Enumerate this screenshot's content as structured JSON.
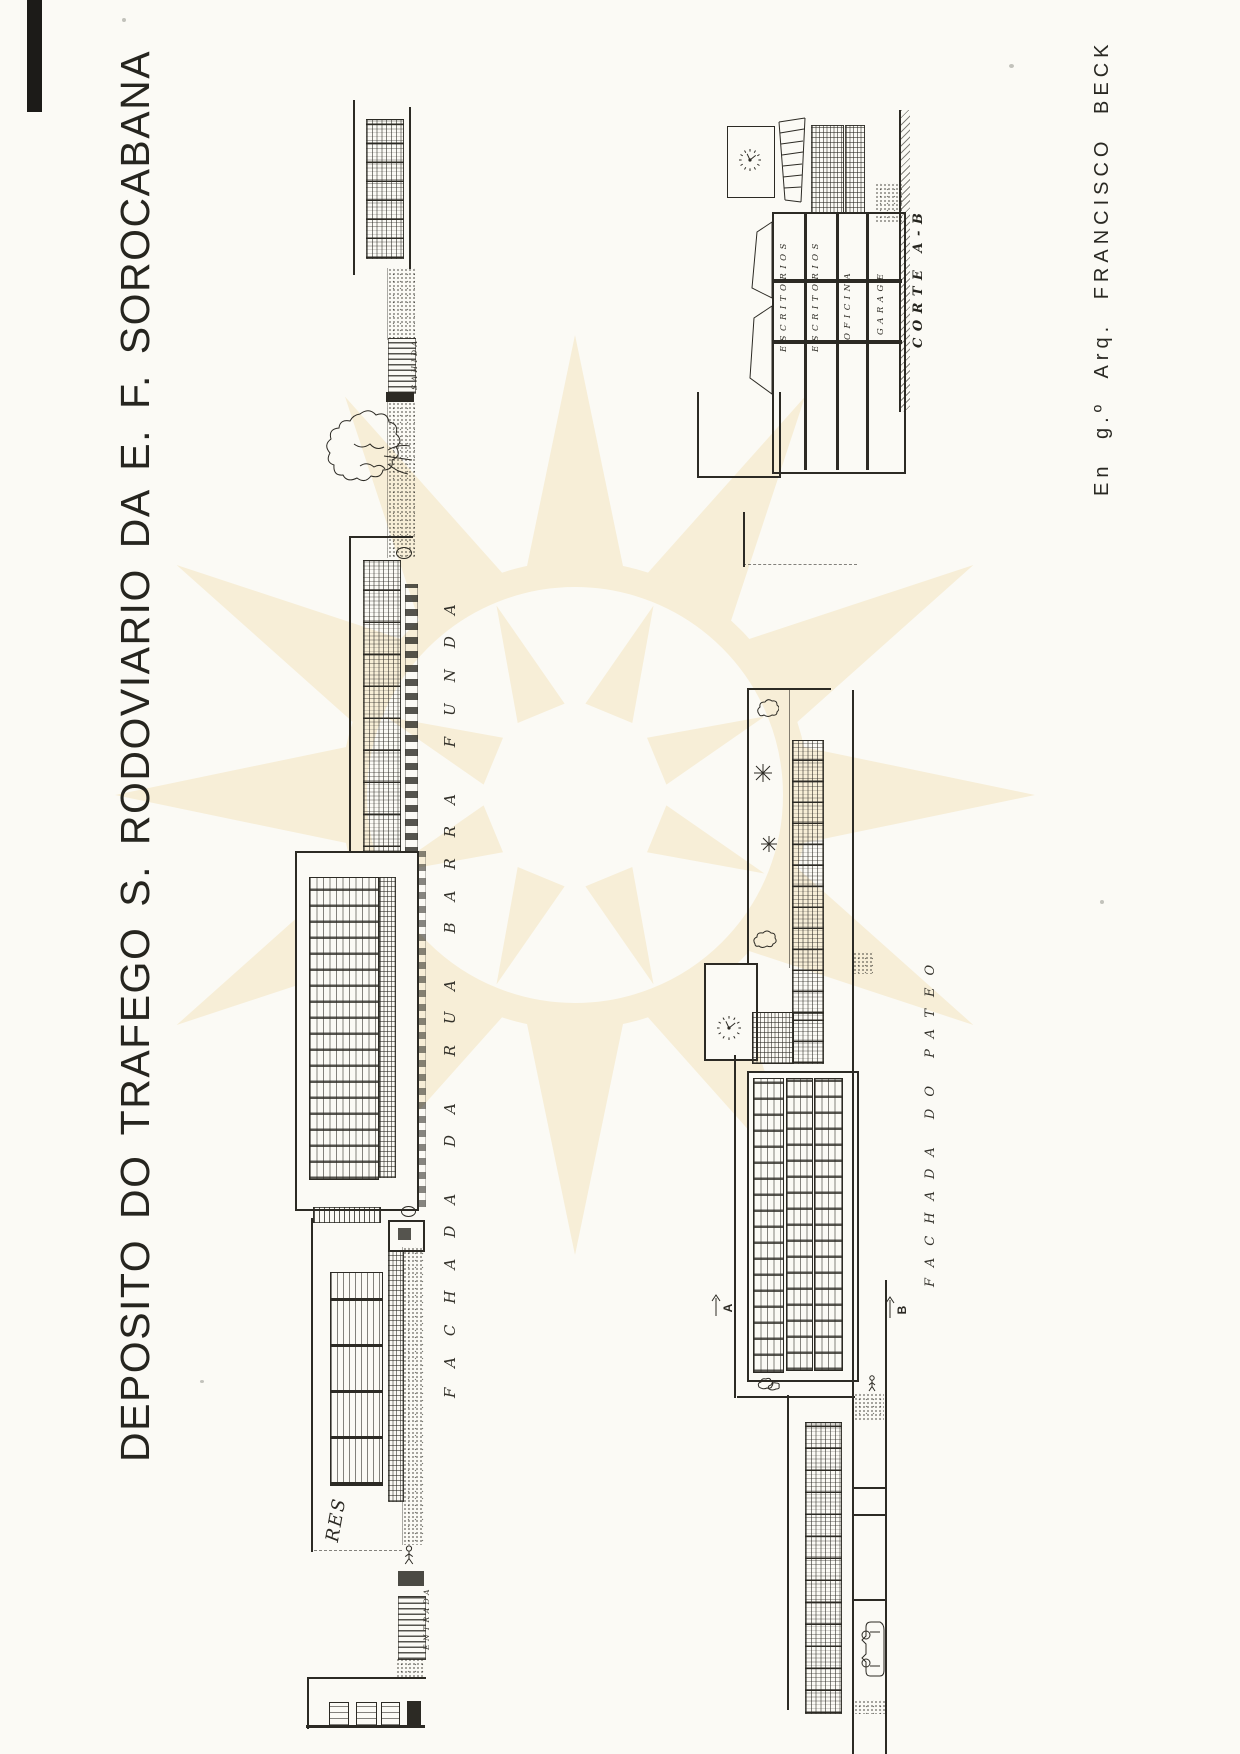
{
  "page": {
    "title": "DEPOSITO DO TRAFEGO S. RODOVIARIO DA E. F. SOROCABANA",
    "credit": "En g.º Arq. FRANCISCO BECK",
    "colors": {
      "paper": "#fbfaf5",
      "ink": "#2c2a24",
      "watermark": "#f7eed7"
    }
  },
  "drawings": {
    "fachada_rua": {
      "label": "FACHADA DA RUA BARRA FUNDA",
      "annotations": {
        "sahida": "SAHIDA",
        "entrada": "ENTRADA",
        "signature": "RES"
      }
    },
    "fachada_pateo": {
      "label": "FACHADA DO PATEO",
      "section_markers": {
        "a": "A",
        "b": "B"
      }
    },
    "corte": {
      "label": "CORTE A-B",
      "rooms": [
        "ESCRITORIOS",
        "ESCRITORIOS",
        "OFICINA",
        "GARAGE"
      ]
    }
  }
}
